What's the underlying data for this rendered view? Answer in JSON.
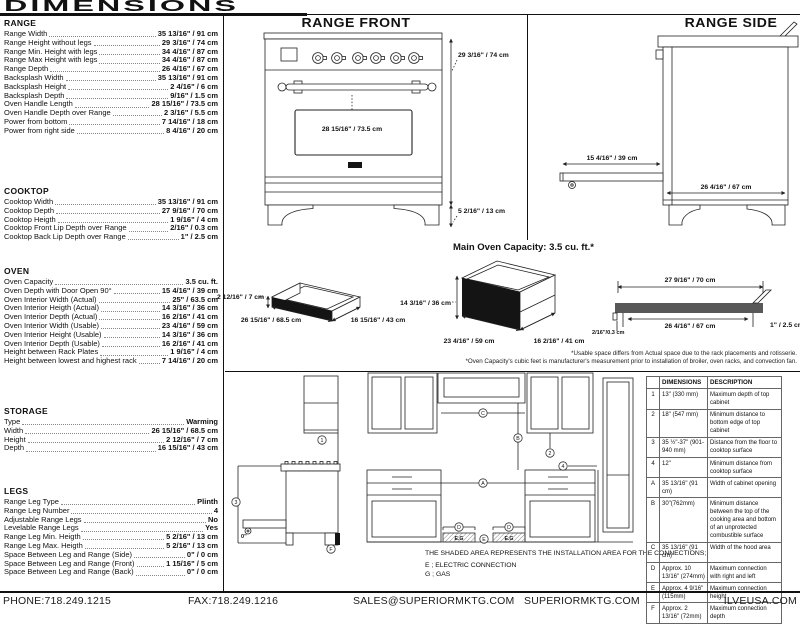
{
  "title": "DIMENSIONS",
  "specs": {
    "sections": [
      {
        "title": "RANGE",
        "rows": [
          {
            "label": "Range Width",
            "value": "35 13/16\" / 91 cm"
          },
          {
            "label": "Range Height without legs",
            "value": "29 3/16\" / 74 cm"
          },
          {
            "label": "Range Min. Height with legs",
            "value": "34 4/16\" / 87 cm"
          },
          {
            "label": "Range Max Height with legs",
            "value": "34 4/16\" / 87 cm"
          },
          {
            "label": "Range Depth",
            "value": "26 4/16\" / 67 cm"
          },
          {
            "label": "Backsplash Width",
            "value": "35 13/16\" / 91 cm"
          },
          {
            "label": "Backsplash Height",
            "value": "2 4/16\" / 6 cm"
          },
          {
            "label": "Backsplash Depth",
            "value": "9/16\" / 1.5 cm"
          },
          {
            "label": "Oven Handle Length",
            "value": "28 15/16\" / 73.5 cm"
          },
          {
            "label": "Oven Handle Depth over Range",
            "value": "2 3/16\" / 5.5 cm"
          },
          {
            "label": "Power from bottom",
            "value": "7 14/16\" / 18 cm"
          },
          {
            "label": "Power from right side",
            "value": "8 4/16\" / 20 cm"
          }
        ]
      },
      {
        "title": "COOKTOP",
        "rows": [
          {
            "label": "Cooktop Width",
            "value": "35 13/16\" / 91 cm"
          },
          {
            "label": "Cooktop Depth",
            "value": "27 9/16\" / 70 cm"
          },
          {
            "label": "Cooktop Heigth",
            "value": "1 9/16\" / 4 cm"
          },
          {
            "label": "Cooktop Front Lip Depth over Range",
            "value": "2/16\" / 0.3 cm"
          },
          {
            "label": "Cooktop Back Lip Depth over Range",
            "value": "1\" / 2.5 cm"
          }
        ]
      },
      {
        "title": "OVEN",
        "rows": [
          {
            "label": "Oven Capacity",
            "value": "3.5 cu. ft."
          },
          {
            "label": "Oven Depth with Door Open 90°",
            "value": "15 4/16\" / 39 cm"
          },
          {
            "label": "Oven Interior Width (Actual)",
            "value": "25\" / 63.5 cm"
          },
          {
            "label": "Oven Interior Heigth (Actual)",
            "value": "14 3/16\" / 36 cm"
          },
          {
            "label": "Oven Interior Depth (Actual)",
            "value": "16 2/16\" / 41 cm"
          },
          {
            "label": "Oven Interior Width (Usable)",
            "value": "23 4/16\" / 59 cm"
          },
          {
            "label": "Oven Interior Height (Usable)",
            "value": "14 3/16\" / 36 cm"
          },
          {
            "label": "Oven Interior Depth (Usable)",
            "value": "16 2/16\" / 41 cm"
          },
          {
            "label": "Height between Rack Plates",
            "value": "1 9/16\" / 4 cm"
          },
          {
            "label": "Height between lowest and highest rack",
            "value": "7 14/16\" / 20 cm"
          }
        ]
      },
      {
        "title": "STORAGE",
        "rows": [
          {
            "label": "Type",
            "value": "Warming"
          },
          {
            "label": "Width",
            "value": "26 15/16\" / 68.5 cm"
          },
          {
            "label": "Height",
            "value": "2 12/16\" / 7 cm"
          },
          {
            "label": "Depth",
            "value": "16 15/16\" / 43 cm"
          }
        ]
      },
      {
        "title": "LEGS",
        "rows": [
          {
            "label": "Range Leg Type",
            "value": "Plinth"
          },
          {
            "label": "Range Leg Number",
            "value": "4"
          },
          {
            "label": "Adjustable Range Legs",
            "value": "No"
          },
          {
            "label": "Levelable Range Legs",
            "value": "Yes"
          },
          {
            "label": "Range Leg Min. Heigth",
            "value": "5 2/16\" / 13 cm"
          },
          {
            "label": "Range Leg Max. Heigth",
            "value": "5 2/16\" / 13 cm"
          },
          {
            "label": "Space Between Leg and Range (Side)",
            "value": "0\" / 0 cm"
          },
          {
            "label": "Space Between Leg and Range (Front)",
            "value": "1 15/16\" / 5 cm"
          },
          {
            "label": "Space Between Leg and Range (Back)",
            "value": "0\" / 0 cm"
          }
        ]
      }
    ]
  },
  "range_front": {
    "title": "RANGE FRONT",
    "inner_label": "28 15/16\" / 73.5 cm",
    "height_label": "29 3/16\" / 74 cm",
    "leg_label": "5 2/16\" / 13 cm"
  },
  "range_side": {
    "title": "RANGE SIDE",
    "door_label": "15 4/16\" / 39 cm",
    "depth_label": "26 4/16\" / 67 cm"
  },
  "capacity_heading": "Main Oven Capacity: 3.5 cu. ft.*",
  "drawer_diagram": {
    "height": "2 12/16\" / 7 cm",
    "width": "26 15/16\" / 68.5 cm",
    "depth": "16 15/16\" / 43 cm"
  },
  "oven_diagram": {
    "height": "14 3/16\" / 36 cm",
    "width": "23 4/16\" / 59 cm",
    "depth": "16 2/16\" / 41 cm"
  },
  "cooktop_diagram": {
    "width_top": "27 9/16\" / 70 cm",
    "width_inner": "26 4/16\" / 67 cm",
    "back_lip": "1\" / 2.5 cm",
    "front_lip": "2/16\"/0.3 cm"
  },
  "footnotes": {
    "line1": "*Usable space differs from Actual space due to the rack placements and rotisserie.",
    "line2": "*Oven Capacity's cubic feet is manufacturer's measurement prior to installation of broiler, oven racks, and convection fan."
  },
  "installation": {
    "note": "THE SHADED AREA REPRESENTS THE INSTALLATION AREA FOR THE CONNECTIONS;",
    "electric_note": "E ; ELECTRIC CONNECTION",
    "gas_note": "G ; GAS",
    "zero": "0\"",
    "eg": "E.G",
    "markers": {
      "n1": "1",
      "n2": "2",
      "n3": "3",
      "n4": "4",
      "a": "A",
      "b": "B",
      "c": "C",
      "d": "D",
      "e": "E",
      "f": "F"
    }
  },
  "dim_table": {
    "col_dimensions": "DIMENSIONS",
    "col_description": "DESCRIPTION",
    "rows": [
      {
        "id": "1",
        "dim": "13\" (330 mm)",
        "desc": "Maximum depth of top cabinet"
      },
      {
        "id": "2",
        "dim": "18\" (547 mm)",
        "desc": "Minimum distance to bottom edge of top cabinet"
      },
      {
        "id": "3",
        "dim": "35 ½\"-37\" (901-940 mm)",
        "desc": "Distance from the floor to cooktop surface"
      },
      {
        "id": "4",
        "dim": "12\"",
        "desc": "Minimum distance from cooktop surface"
      },
      {
        "id": "A",
        "dim": "35 13/16\" (91 cm)",
        "desc": "Width of cabinet opening"
      },
      {
        "id": "B",
        "dim": "30\"(762mm)",
        "desc": "Minimum distance between the top of the cooking area and bottom of an unprotected combustible surface"
      },
      {
        "id": "C",
        "dim": "35 13/16\" (91 cm)",
        "desc": "Width of the hood area"
      },
      {
        "id": "D",
        "dim": "Approx. 10 13/16\" (274mm)",
        "desc": "Maximum connection with right and left"
      },
      {
        "id": "E",
        "dim": "Approx. 4 9/16\" (115mm)",
        "desc": "Maximum connection height"
      },
      {
        "id": "F",
        "dim": "Approx. 2 13/16\" (72mm)",
        "desc": "Maximum connection depth"
      }
    ]
  },
  "footer": {
    "phone": "PHONE:718.249.1215",
    "fax": "FAX:718.249.1216",
    "email": "SALES@SUPERIORMKTG.COM",
    "site": "SUPERIORMKTG.COM",
    "brand": "ILVEUSA.COM"
  }
}
